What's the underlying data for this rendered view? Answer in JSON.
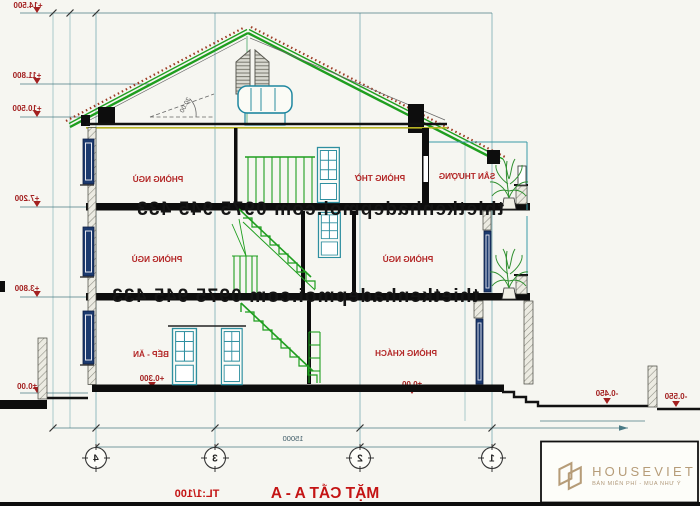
{
  "sheet": {
    "title": "MẶT CẮT  A - A",
    "title_scale": "TL:1/100",
    "watermark": "thietkenhadepmoi.com 0975 945 433",
    "roof_angle": "30.00",
    "levels": {
      "top": "+14.500",
      "ridge_low": "+11.800",
      "eave": "+10.500",
      "floor3": "+7.200",
      "floor2": "+3.800",
      "ground_left": "±0.00",
      "ground_living": "±0.00",
      "kitchen": "+0.300",
      "yard_near": "-0.450",
      "yard_far": "-0.550"
    },
    "rooms": {
      "bedroom_top": "PHÒNG NGỦ",
      "worship": "PHÒNG THỜ",
      "terrace": "SÂN THƯỢNG",
      "bedroom_mid_left": "PHÒNG NGỦ",
      "bedroom_mid_right": "PHÒNG NGỦ",
      "kitchen_dining": "BẾP - ĂN",
      "living": "PHÒNG KHÁCH"
    },
    "dimensions": {
      "total_width": "15000"
    },
    "grid_labels": [
      "4",
      "3",
      "2",
      "1"
    ]
  },
  "logo": {
    "name": "HOUSEVIET",
    "tagline": "BÁN MIỄN PHÍ - MUA NHƯ Ý"
  },
  "colors": {
    "drawing_green": "#1f9e1f",
    "drawing_teal": "#2e8fa0",
    "label_red": "#b32626",
    "roof_tile": "#9c3a22",
    "window_navy": "#1c3a6e",
    "logo_gold": "#b69c78"
  }
}
